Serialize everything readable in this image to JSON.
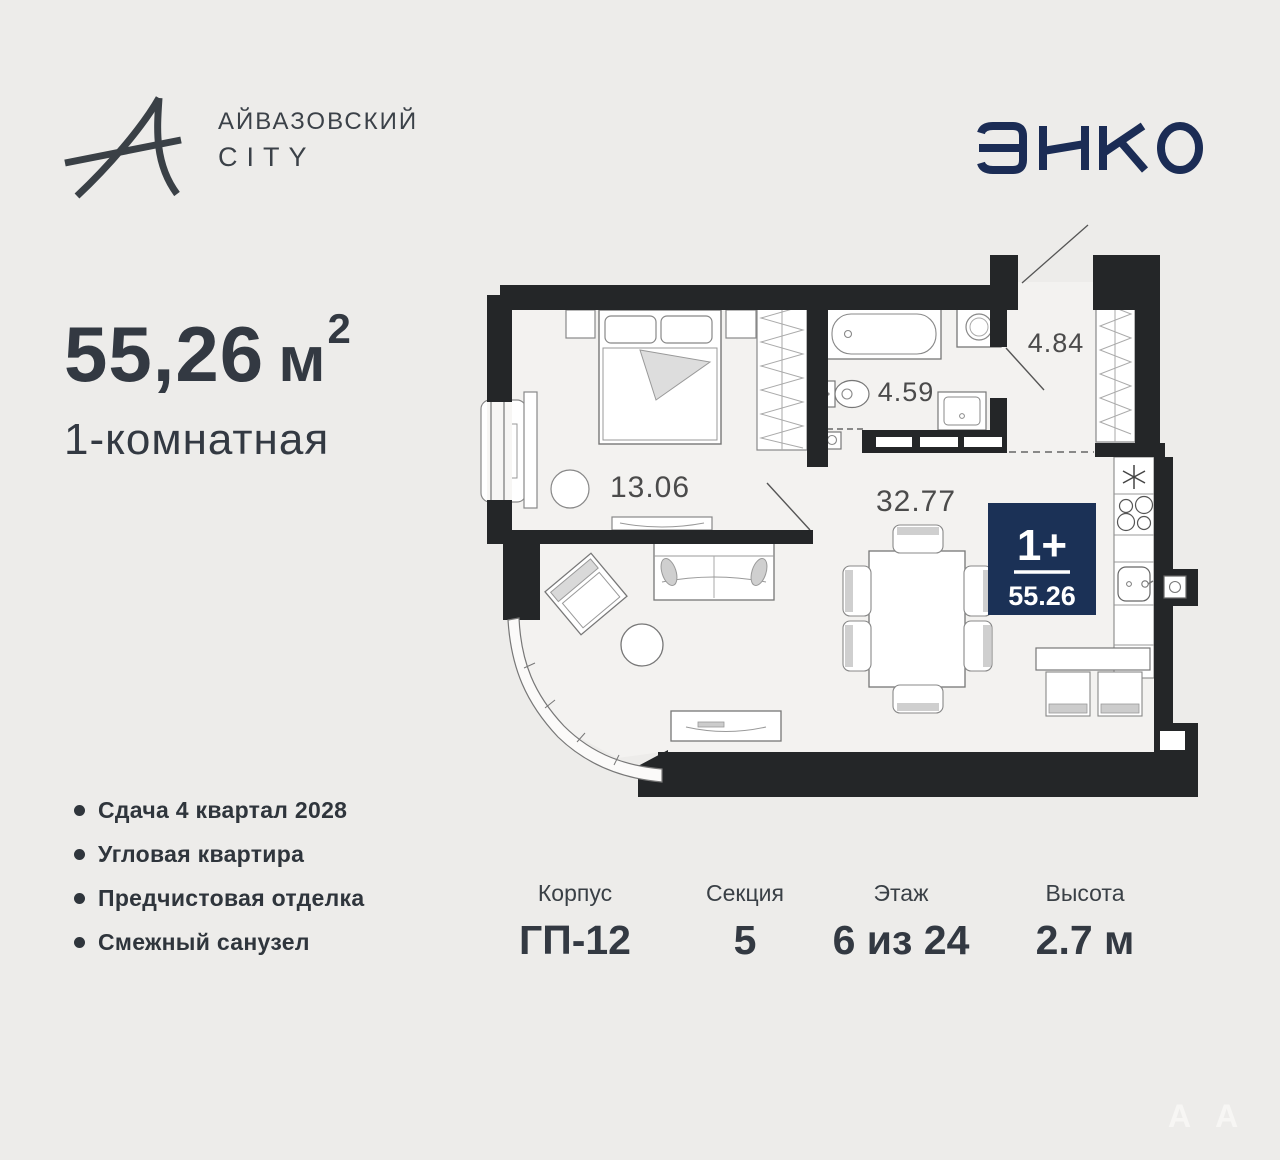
{
  "brand": {
    "line1": "АЙВАЗОВСКИЙ",
    "line2": "CITY"
  },
  "developer": {
    "name": "ЭНКО"
  },
  "listing": {
    "area_value": "55,26",
    "area_unit": "м",
    "area_superscript": "2",
    "type_label": "1-комнатная"
  },
  "features": [
    "Сдача 4 квартал 2028",
    "Угловая квартира",
    "Предчистовая отделка",
    "Смежный санузел"
  ],
  "plan": {
    "room_areas": {
      "bedroom": "13.06",
      "living_kitchen": "32.77",
      "bathroom": "4.59",
      "hallway": "4.84"
    },
    "badge": {
      "layout": "1+",
      "area": "55.26"
    }
  },
  "specs": [
    {
      "label": "Корпус",
      "value": "ГП-12"
    },
    {
      "label": "Секция",
      "value": "5"
    },
    {
      "label": "Этаж",
      "value": "6 из 24"
    },
    {
      "label": "Высота",
      "value": "2.7 м"
    }
  ],
  "watermark": {
    "glyph": "А"
  },
  "colors": {
    "background": "#edecea",
    "text_dark": "#343a41",
    "navy_badge": "#1b3156",
    "navy_logo": "#1b2c55",
    "wall": "#242628",
    "floor": "#f3f2f0"
  }
}
